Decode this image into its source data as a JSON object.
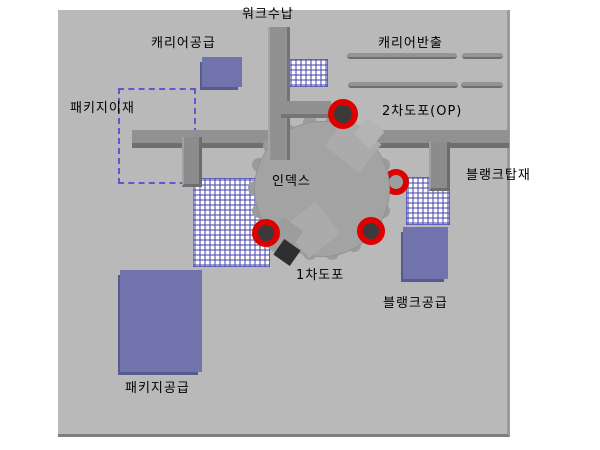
{
  "diagram": {
    "type": "machine-layout-diagram",
    "labels": {
      "work_storage": "워크수납",
      "carrier_supply": "캐리어공급",
      "carrier_unload": "캐리어반출",
      "package_transfer": "패키지이재",
      "second_coating": "2차도포(OP)",
      "index_table": "인덱스",
      "blank_mount": "블랭크탑재",
      "first_coating": "1차도포",
      "blank_supply": "블랭크공급",
      "package_supply": "패키지공급"
    },
    "colors": {
      "panel_bg": "#b9b9b9",
      "unit_purple": "#7173ac",
      "unit_purple_shadow": "#585a8e",
      "grid_blue": "#4e4eb0",
      "bar_gray": "#919191",
      "bar_shadow": "#6f6f6f",
      "turntable_gray": "#a3a3a3",
      "ring_red": "#dd0000",
      "ring_center": "#3a3a3a",
      "dashed_blue": "#5a5acc"
    }
  }
}
